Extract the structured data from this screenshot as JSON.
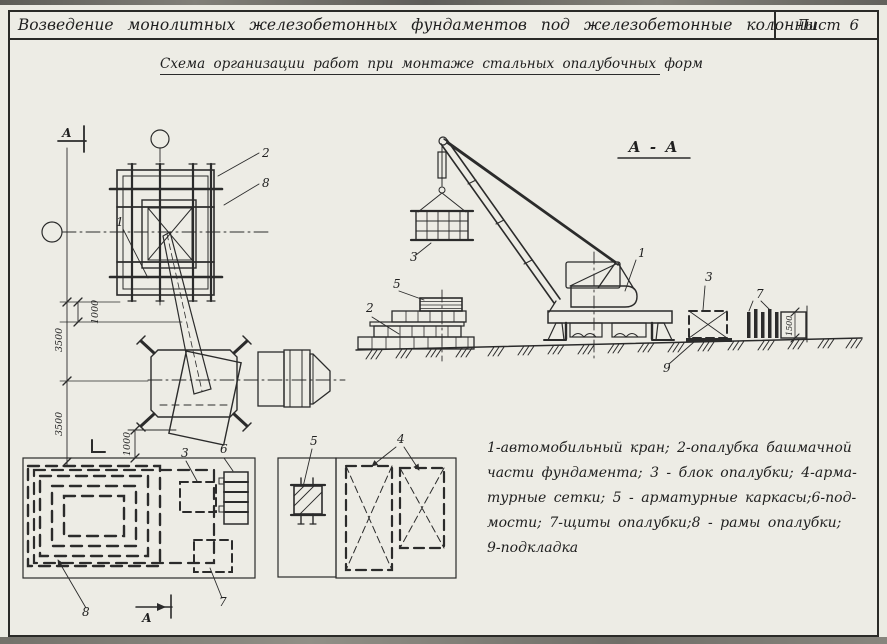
{
  "title_block": {
    "title": "Возведение монолитных железобетонных фундаментов под железобетонные колонны",
    "sheet": "Лист 6"
  },
  "subtitle": "Схема организации работ при монтаже стальных опалубочных форм",
  "section_label": "А - А",
  "section_marks": {
    "top": "А",
    "bottom": "А"
  },
  "dimensions": {
    "v3500_top": "3500",
    "v3500_bottom": "3500",
    "h1000_top": "1000",
    "h1000_bottom": "1000",
    "panel_height": "1500"
  },
  "callouts": {
    "plan_crane": "1",
    "plan_formwork": "2",
    "plan_frames": "8",
    "storage_block": "3",
    "storage_scaffold": "6",
    "storage_panel": "7",
    "storage_forms": "8",
    "yard_cages": "5",
    "yard_mesh": "4",
    "sec_crane": "1",
    "sec_formwork": "2",
    "sec_block_hoisted": "3",
    "sec_cages": "5",
    "sec_block_ground": "3",
    "sec_panels": "7",
    "sec_pad": "9"
  },
  "legend": {
    "lines": [
      "1-автомобильный кран; 2-опалубка башмачной",
      "части фундамента; 3 - блок опалубки; 4-арма-",
      "турные сетки; 5 - арматурные каркасы;6-под-",
      "мости; 7-щиты опалубки;8 - рамы опалубки;",
      "9-подкладка"
    ]
  }
}
